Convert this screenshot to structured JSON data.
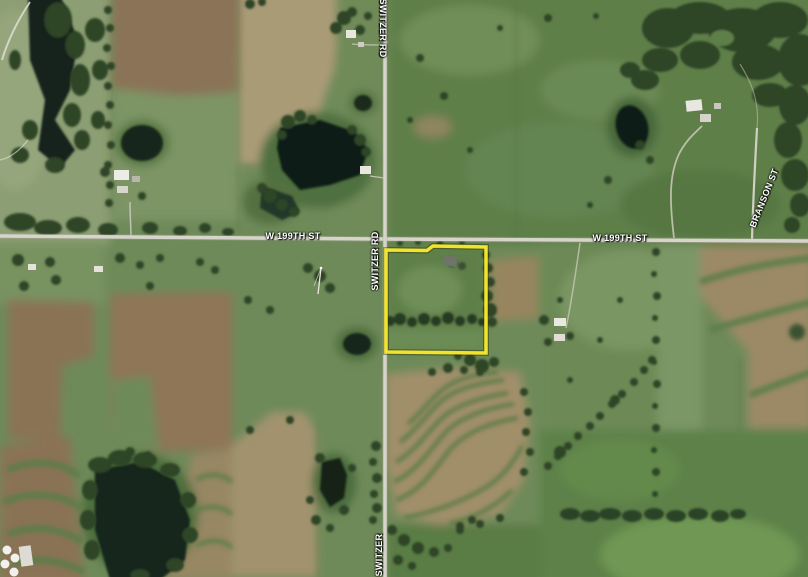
{
  "app": {
    "type": "satellite-map-view"
  },
  "map": {
    "road_labels": {
      "switzer_rd_top": "SWITZER RD",
      "switzer_rd_mid": "SWITZER RD",
      "switzer_bottom": "SWITZER",
      "w199th_left": "W 199TH ST",
      "w199th_right": "W 199TH ST",
      "branson": "BRANSON ST"
    },
    "parcel": {
      "outline_color": "#F2E32C",
      "shadow_color": "rgba(40,40,0,0.4)"
    },
    "palette": {
      "pasture_green": "#6e8a59",
      "crop_brown": "#8a7355",
      "crop_tan": "#a2936e",
      "tree_dark": "#2e4527",
      "water_dark": "#14231a",
      "road_gray": "#d7d5cb"
    }
  }
}
